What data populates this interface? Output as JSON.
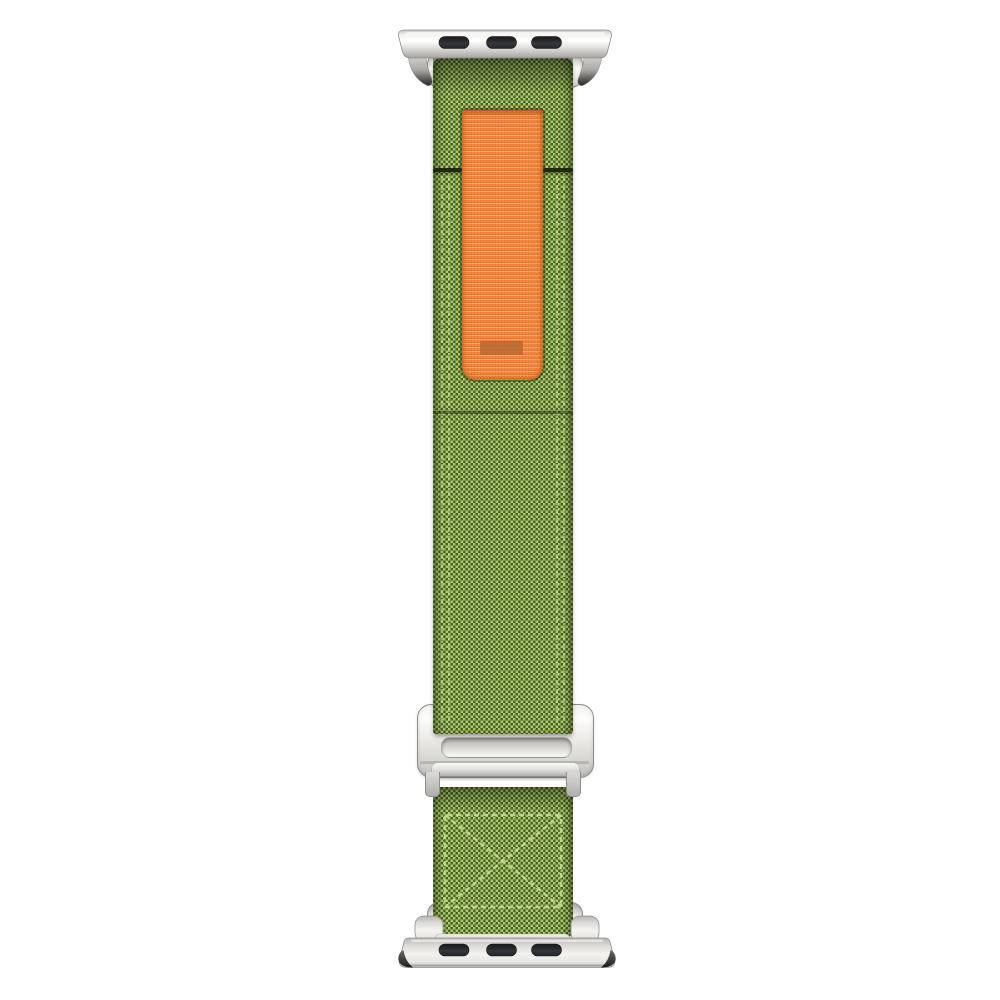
{
  "image": {
    "type": "product-photo",
    "subject": "Green woven nylon trail-loop watch band with orange pull tab, silver slide buckle and silver lug adapters, on white background",
    "text_content": "none"
  },
  "colors": {
    "white": "#ffffff",
    "green_base": "#86a845",
    "green_dark": "#223409",
    "green_light": "#c3de88",
    "green_tint": "rgba(134,168,69,0.40)",
    "stitch": "#cfe29a",
    "seam_dark": "#20290f",
    "orange": "#f6873c",
    "orange_marker": "#b8692f",
    "silver_light": "#fafaf8",
    "silver_mid": "#dbdad6",
    "silver_shade": "#b0afab",
    "silver_deep": "#8f8e8a",
    "slot_black": "#26272a",
    "claw_dark": "#2e2e2c"
  },
  "parts": {
    "top_adapter": {
      "name": "Watch lug adapter (top)",
      "slots": 3
    },
    "top_channel": {
      "name": "Adapter strap channel (top)"
    },
    "upper_strap": {
      "name": "Upper strap, woven green nylon"
    },
    "pull_tab": {
      "name": "Orange nylon pull loop"
    },
    "tab_marker": {
      "name": "Debossed marker on pull tab"
    },
    "fold_seam": {
      "name": "Fold-over seam"
    },
    "buckle": {
      "name": "Silver G-hook slide buckle"
    },
    "lower_strap": {
      "name": "Lower strap with box-X stitching"
    },
    "bottom_adapter": {
      "name": "Watch lug adapter (bottom)",
      "slots": 3
    },
    "bottom_channel": {
      "name": "Adapter strap channel (bottom)"
    }
  }
}
